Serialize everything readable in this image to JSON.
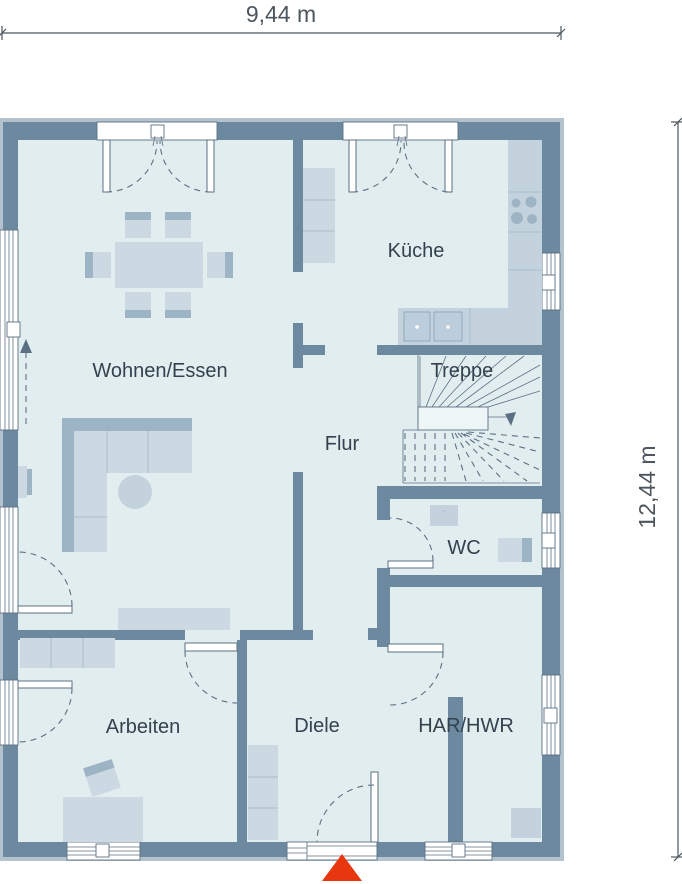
{
  "plan": {
    "dimensions": {
      "width_label": "9,44 m",
      "height_label": "12,44 m"
    },
    "rooms": [
      {
        "id": "wohnen-essen",
        "label": "Wohnen/Essen"
      },
      {
        "id": "kueche",
        "label": "Küche"
      },
      {
        "id": "treppe",
        "label": "Treppe"
      },
      {
        "id": "flur",
        "label": "Flur"
      },
      {
        "id": "wc",
        "label": "WC"
      },
      {
        "id": "arbeiten",
        "label": "Arbeiten"
      },
      {
        "id": "diele",
        "label": "Diele"
      },
      {
        "id": "har-hwr",
        "label": "HAR/HWR"
      }
    ],
    "icons": {
      "entrance_arrow": "entrance-direction-arrow",
      "stairs_arrow": "stairs-down-arrow",
      "sliding_door_arrow": "sliding-door-direction-arrow"
    },
    "colors": {
      "wall": "#6d89a0",
      "wall_outer": "#b3c2cd",
      "floor": "#e2edf0",
      "furniture": "#ccd9e2",
      "furniture_dark": "#9db4c5",
      "furniture_mid": "#c3d2dc",
      "furniture_divider": "#a9bdcb",
      "line": "#5b7183",
      "label_text": "#33424e",
      "dim_text": "#4d565e",
      "entrance_arrow": "#e8360e",
      "window_frame": "#ffffff"
    }
  }
}
